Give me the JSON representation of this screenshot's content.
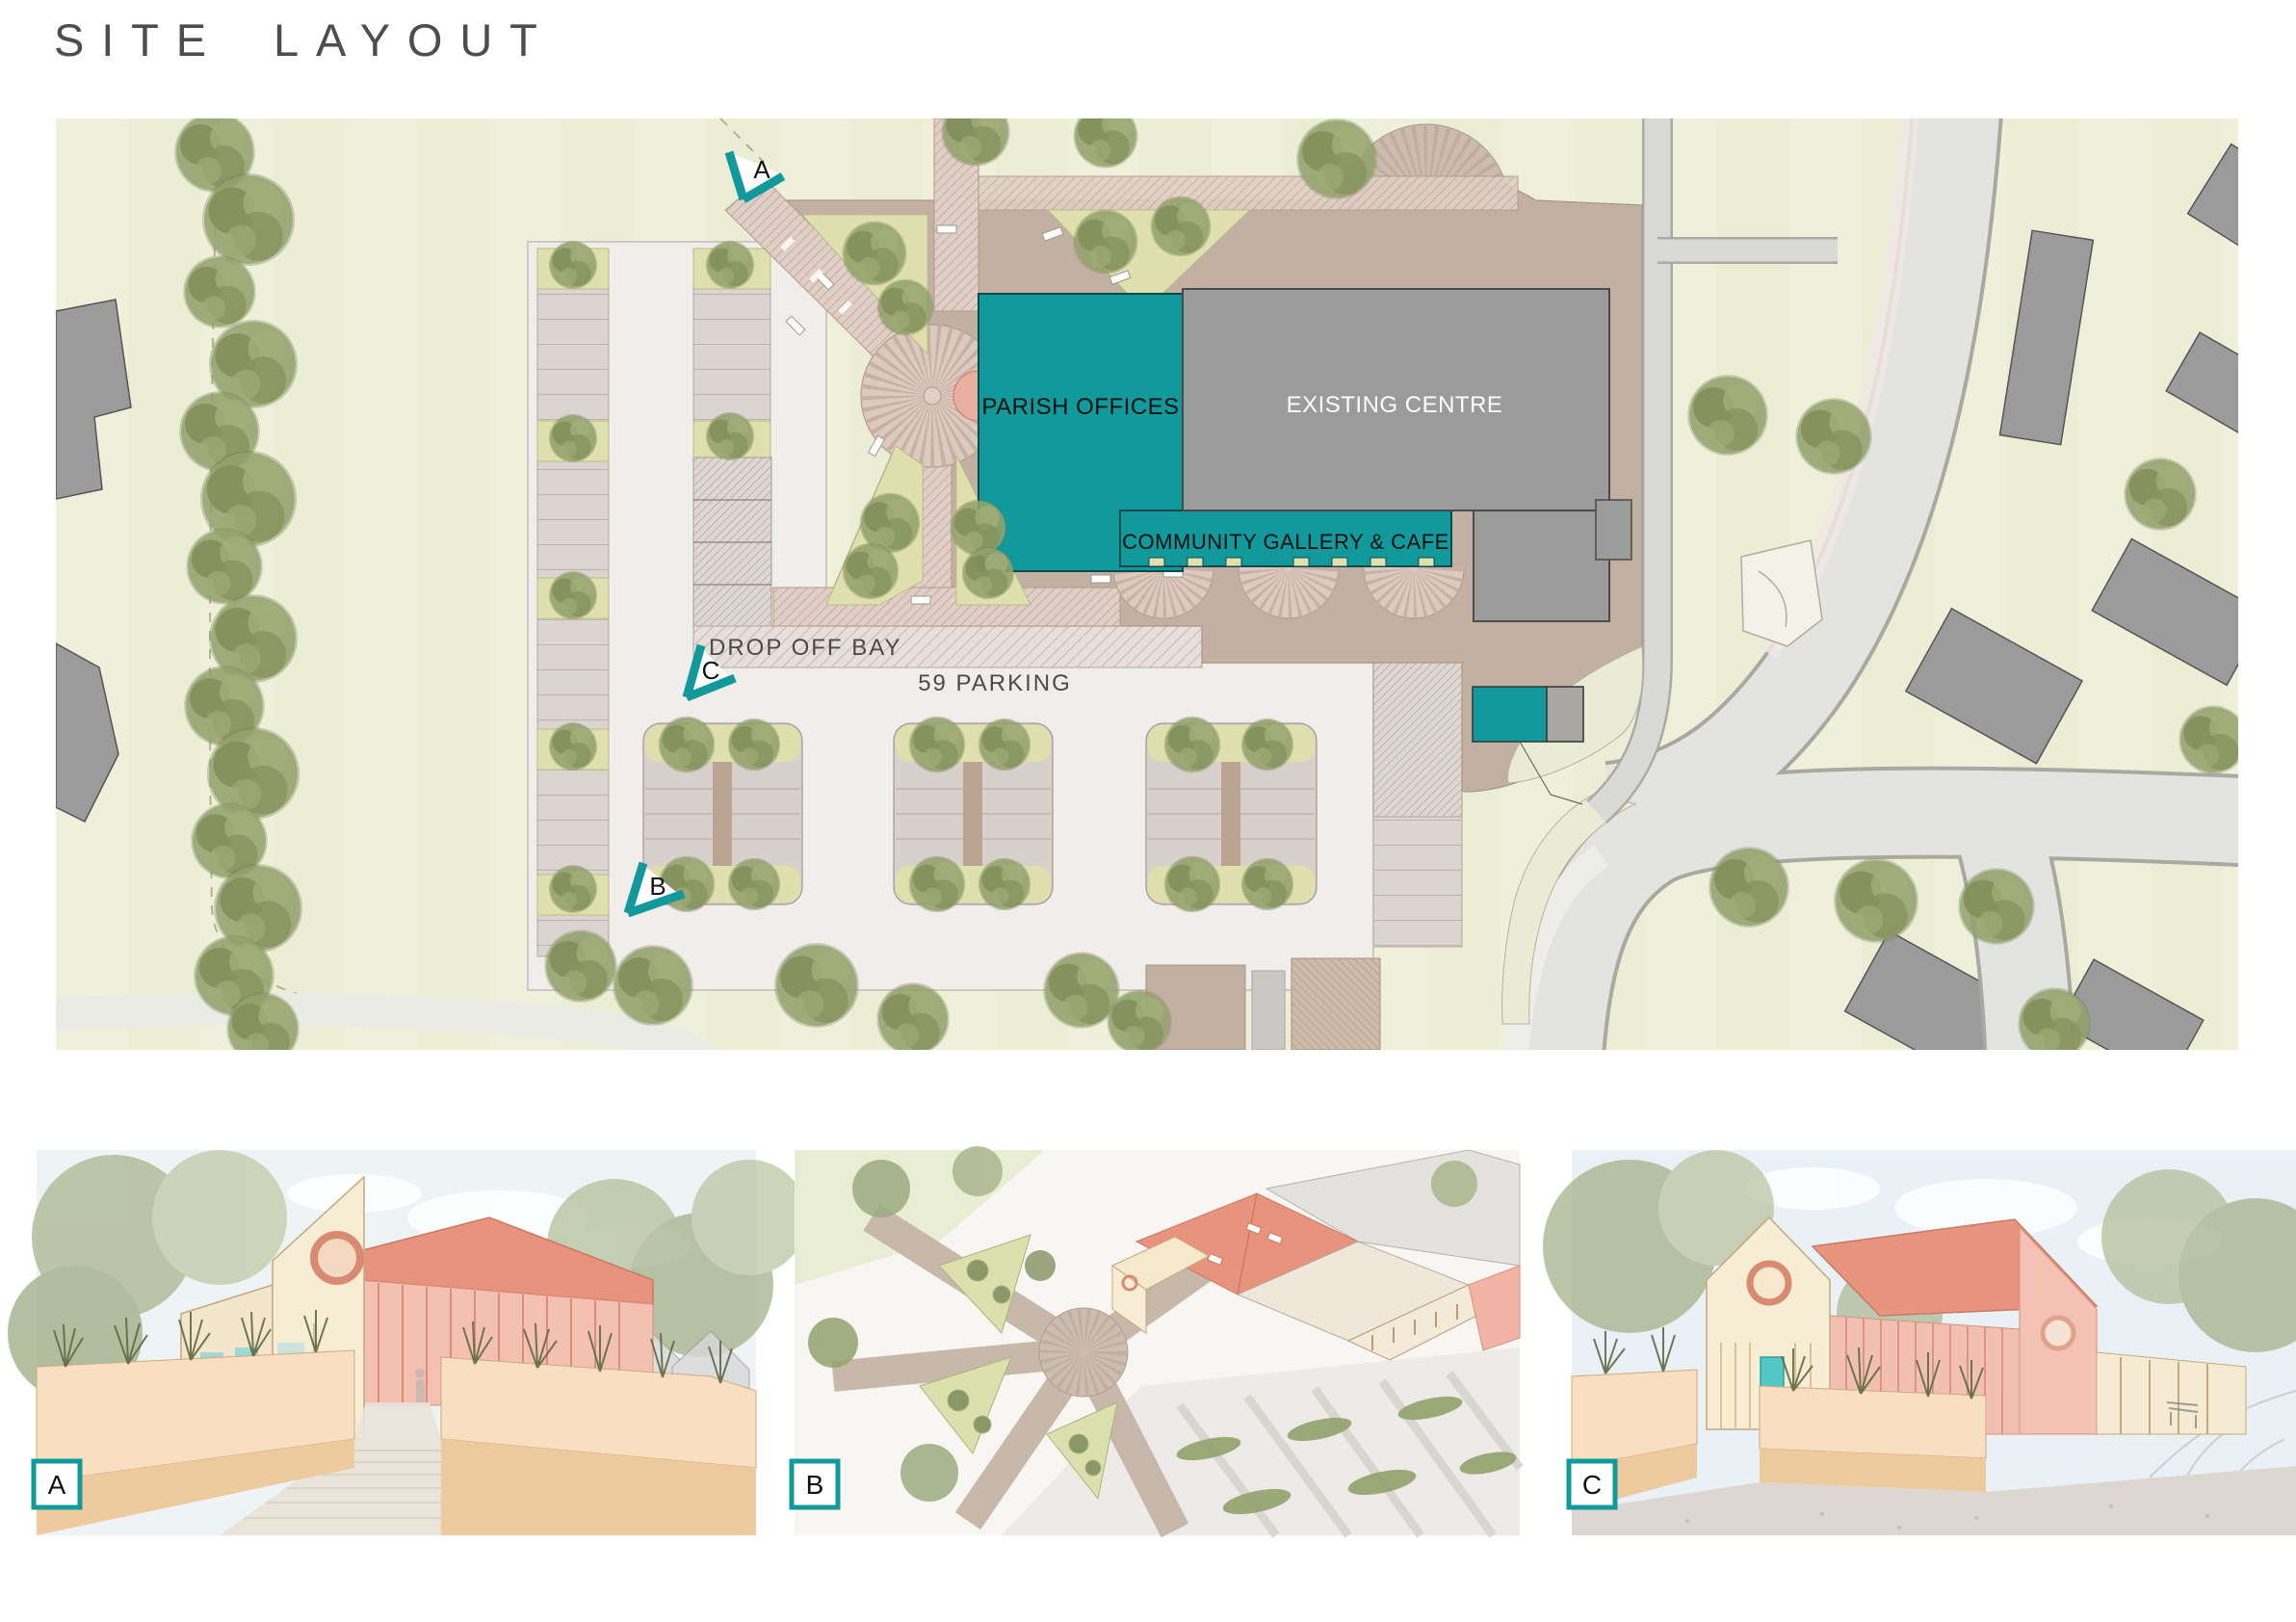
{
  "page": {
    "title": "SITE LAYOUT"
  },
  "plan": {
    "labels": {
      "parish_offices": "PARISH OFFICES",
      "existing_centre": "EXISTING CENTRE",
      "community_gallery": "COMMUNITY GALLERY & CAFE",
      "drop_off_bay": "DROP OFF BAY",
      "parking_count": "59 PARKING"
    },
    "markers": [
      {
        "id": "A"
      },
      {
        "id": "B"
      },
      {
        "id": "C"
      }
    ],
    "colors": {
      "proposed_teal": "#12999b",
      "existing_grey": "#9b9b9b",
      "plaza_tan": "#c2b1a3",
      "grass_green": "#edefd9",
      "road_grey": "#e3e4e0",
      "parking_surface": "#f0edea",
      "planting_green": "#dfe0ae",
      "tree_green": "#8a9768",
      "marker_teal": "#12999b"
    }
  },
  "renders": [
    {
      "id": "A"
    },
    {
      "id": "B"
    },
    {
      "id": "C"
    }
  ]
}
